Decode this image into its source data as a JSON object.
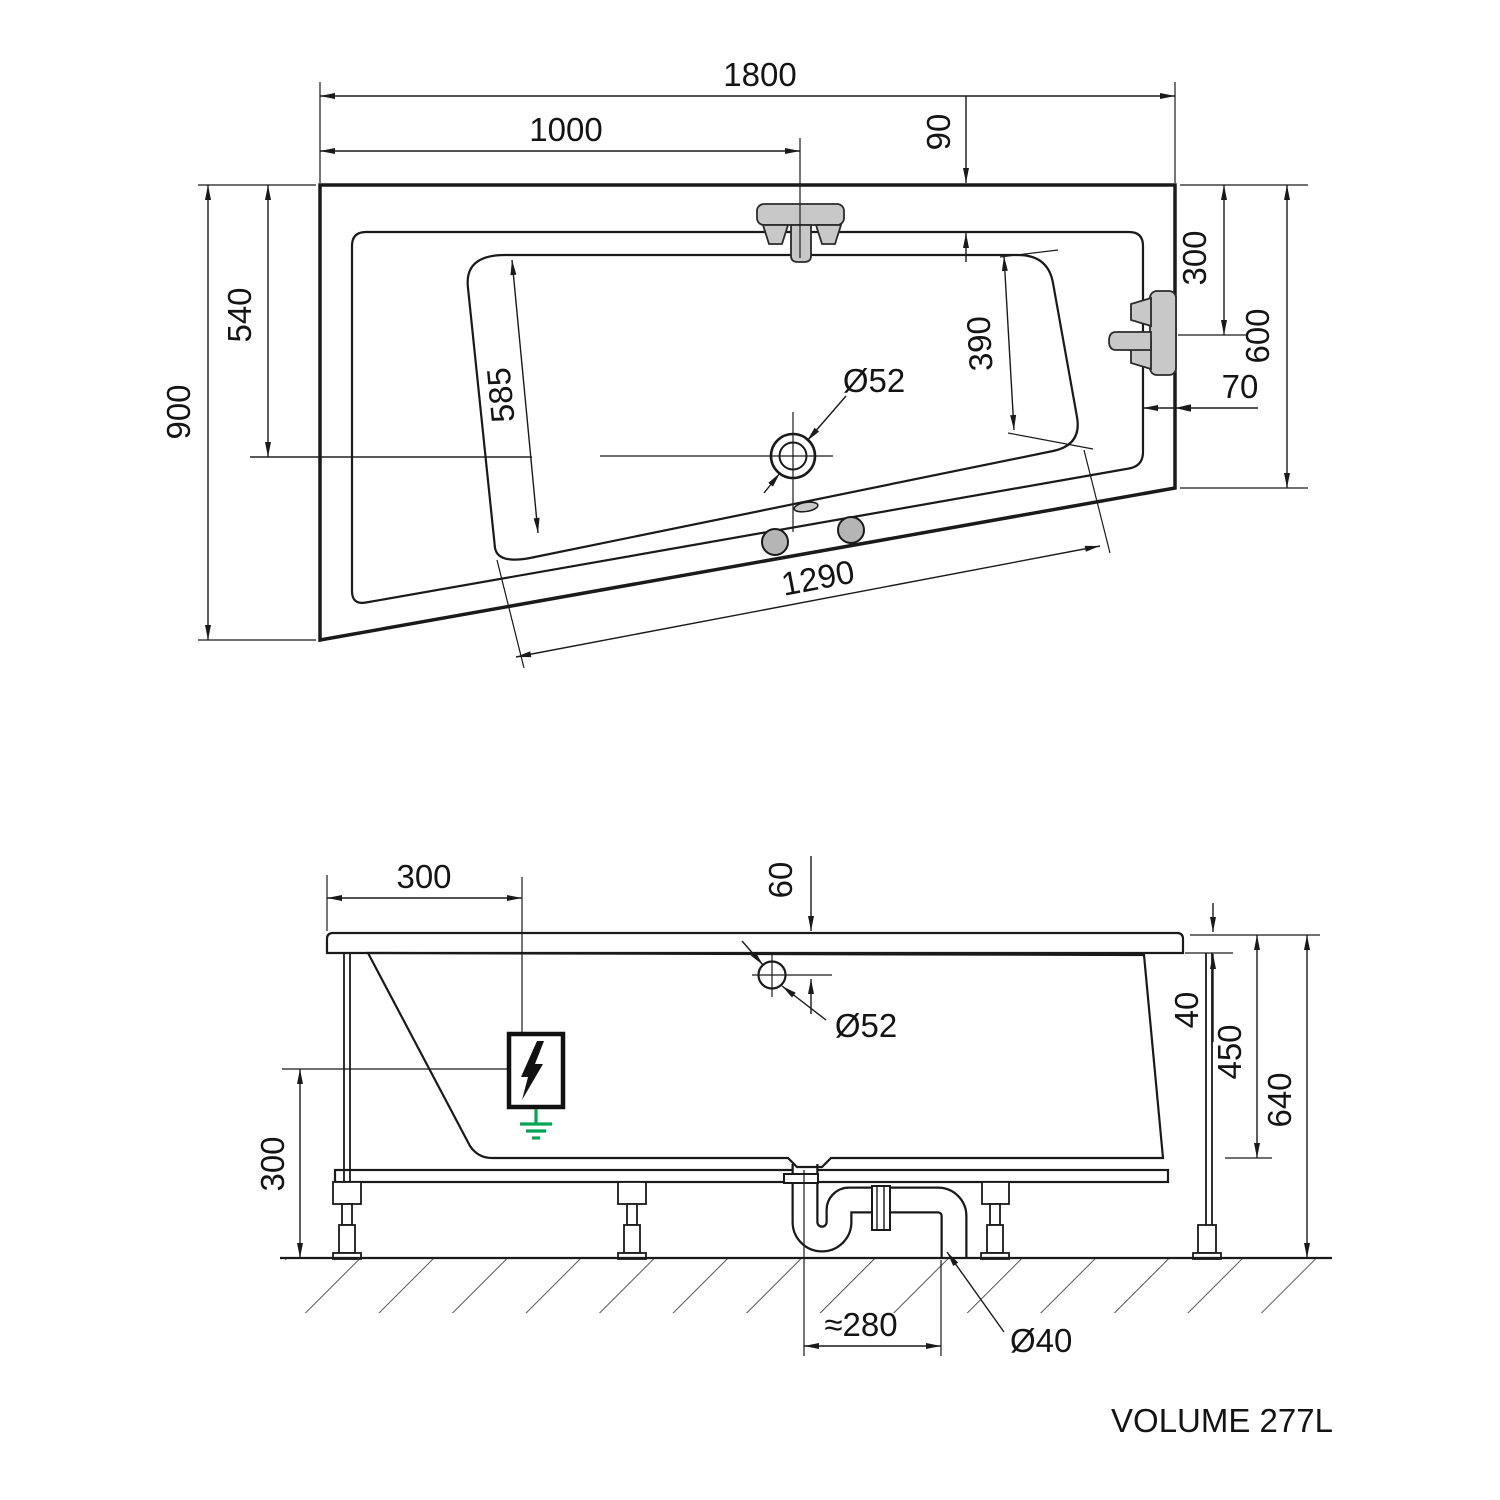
{
  "drawing_type": "bathtub-technical-drawing",
  "colors": {
    "line": "#1a1a1a",
    "tub_fill": "#e9e9e9",
    "fixture_gray": "#c8c8c8",
    "foot_gray": "#b5b5b5",
    "ground_green": "#00a651",
    "background": "#ffffff"
  },
  "top_view": {
    "dims": {
      "length_overall": "1800",
      "faucet_from_left": "1000",
      "rim_inset_top": "90",
      "width_left": "900",
      "width_inner_left": "540",
      "basin_width_head": "585",
      "basin_width_foot": "390",
      "faucet_from_top": "300",
      "width_right": "600",
      "rim_inset_right": "70",
      "basin_length_bottom": "1290",
      "drain_diameter": "Ø52"
    }
  },
  "side_view": {
    "dims": {
      "electric_from_left": "300",
      "overflow_from_top": "60",
      "overflow_diameter": "Ø52",
      "rim_thickness": "40",
      "body_height": "450",
      "total_height": "640",
      "frame_clearance": "300",
      "trap_offset": "≈280",
      "waste_pipe_diameter": "Ø40"
    }
  },
  "footer": {
    "volume_label": "VOLUME 277L"
  }
}
